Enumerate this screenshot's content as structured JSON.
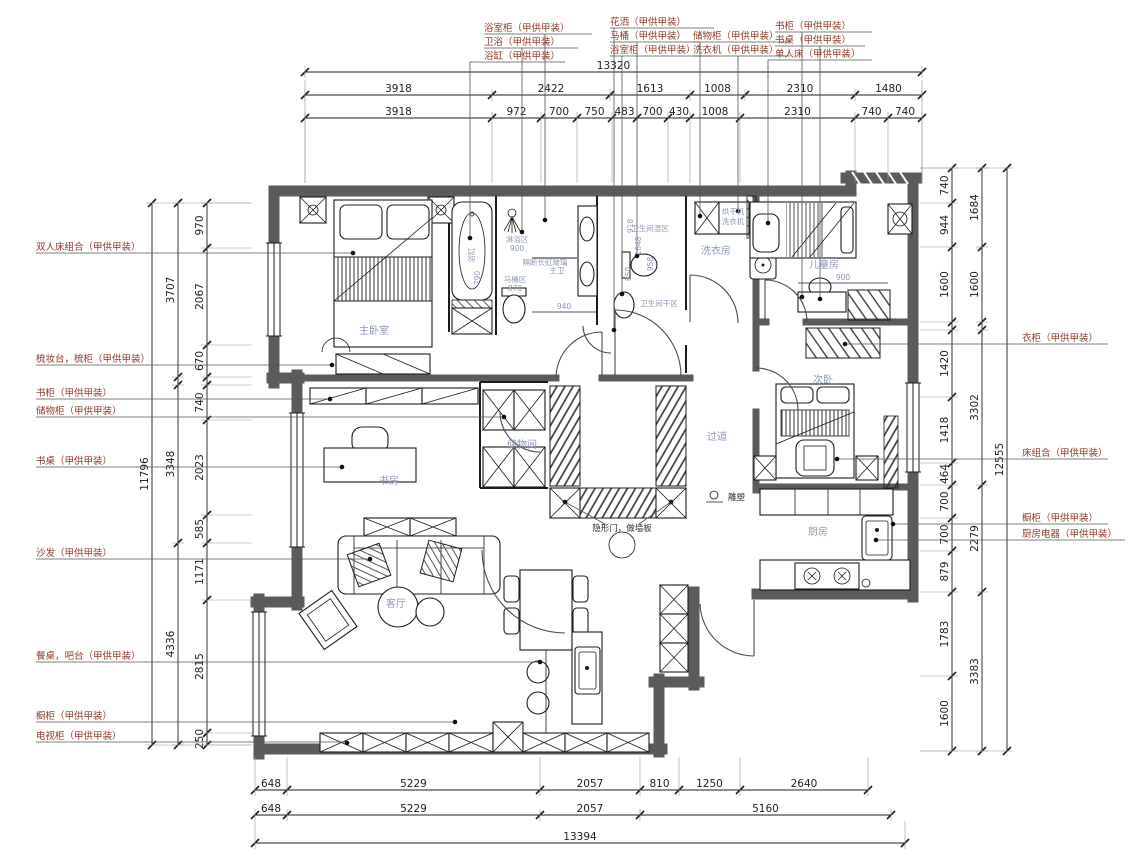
{
  "palette": {
    "wall": "#5b5b5b",
    "line": "#1c1c1c",
    "callout": "#8a3b2b",
    "room_label": "#8e99b3",
    "dimension": "#222222",
    "extension": "#9a9a9a",
    "leader": "#555555"
  },
  "callouts": {
    "top": [
      "浴室柜（甲供甲装）",
      "卫浴（甲供甲装）",
      "浴缸（甲供甲装）",
      "花洒（甲供甲装）",
      "马桶（甲供甲装）",
      "浴室柜（甲供甲装）",
      "储物柜（甲供甲装）",
      "洗衣机（甲供甲装）",
      "书柜（甲供甲装）",
      "书桌（甲供甲装）",
      "单人床（甲供甲装）"
    ],
    "left": [
      "双人床组合（甲供甲装）",
      "梳妆台，梳柜（甲供甲装）",
      "书柜（甲供甲装）",
      "储物柜（甲供甲装）",
      "书桌（甲供甲装）",
      "沙发（甲供甲装）",
      "餐桌，吧台（甲供甲装）",
      "橱柜（甲供甲装）",
      "电视柜（甲供甲装）"
    ],
    "right": [
      "衣柜（甲供甲装）",
      "床组合（甲供甲装）",
      "橱柜（甲供甲装）",
      "厨房电器（甲供甲装）"
    ]
  },
  "rooms": {
    "master_bedroom": "主卧室",
    "study": "书房",
    "living": "客厅",
    "storage": "储物间",
    "hallway": "过道",
    "laundry": "洗衣房",
    "kids": "儿童房",
    "second_bedroom": "次卧",
    "kitchen": "厨房",
    "master_bath": "主卫",
    "bath_wet": "卫生间湿区",
    "bath_dry": "卫生间干区",
    "shower_zone": "淋浴区",
    "toilet_zone": "马桶区",
    "bathtub": "浴缸"
  },
  "annotations": {
    "partition_glass": "隔断长虹玻璃",
    "hidden_door": "隐形门，做墙板",
    "sculpture": "雕塑",
    "dryer": "烘干机",
    "washer": "洗衣机"
  },
  "inner_dims": {
    "shower_w": "900",
    "tub_w": "790",
    "toilet_w": "870",
    "vanity": "940",
    "d918": "918",
    "d1648": "1648",
    "d958": "958",
    "d850": "850",
    "kids_desk": "900"
  },
  "dimensions": {
    "top": {
      "total": "13320",
      "row1": [
        "3918",
        "2422",
        "1613",
        "1008",
        "2310",
        "1480"
      ],
      "row2": [
        "3918",
        "972",
        "700",
        "750",
        "483",
        "700",
        "430",
        "1008",
        "2310",
        "740",
        "740"
      ]
    },
    "bottom": {
      "total": "13394",
      "row1": [
        "648",
        "5229",
        "2057",
        "810",
        "1250",
        "2640"
      ],
      "row2": [
        "648",
        "5229",
        "2057",
        "5160"
      ]
    },
    "left": {
      "total": "11796",
      "mid": [
        "3707",
        "",
        "3348",
        "4336"
      ],
      "inner": [
        "970",
        "2067",
        "670",
        "",
        "740",
        "2023",
        "585",
        "1171",
        "2815",
        "250"
      ]
    },
    "right": {
      "total": "12555",
      "mid": [
        "1684",
        "1600",
        "",
        "3302",
        "2279",
        "3383"
      ],
      "inner": [
        "740",
        "944",
        "1600",
        "",
        "1420",
        "1418",
        "464",
        "700",
        "700",
        "879",
        "1783",
        "1600"
      ]
    }
  }
}
